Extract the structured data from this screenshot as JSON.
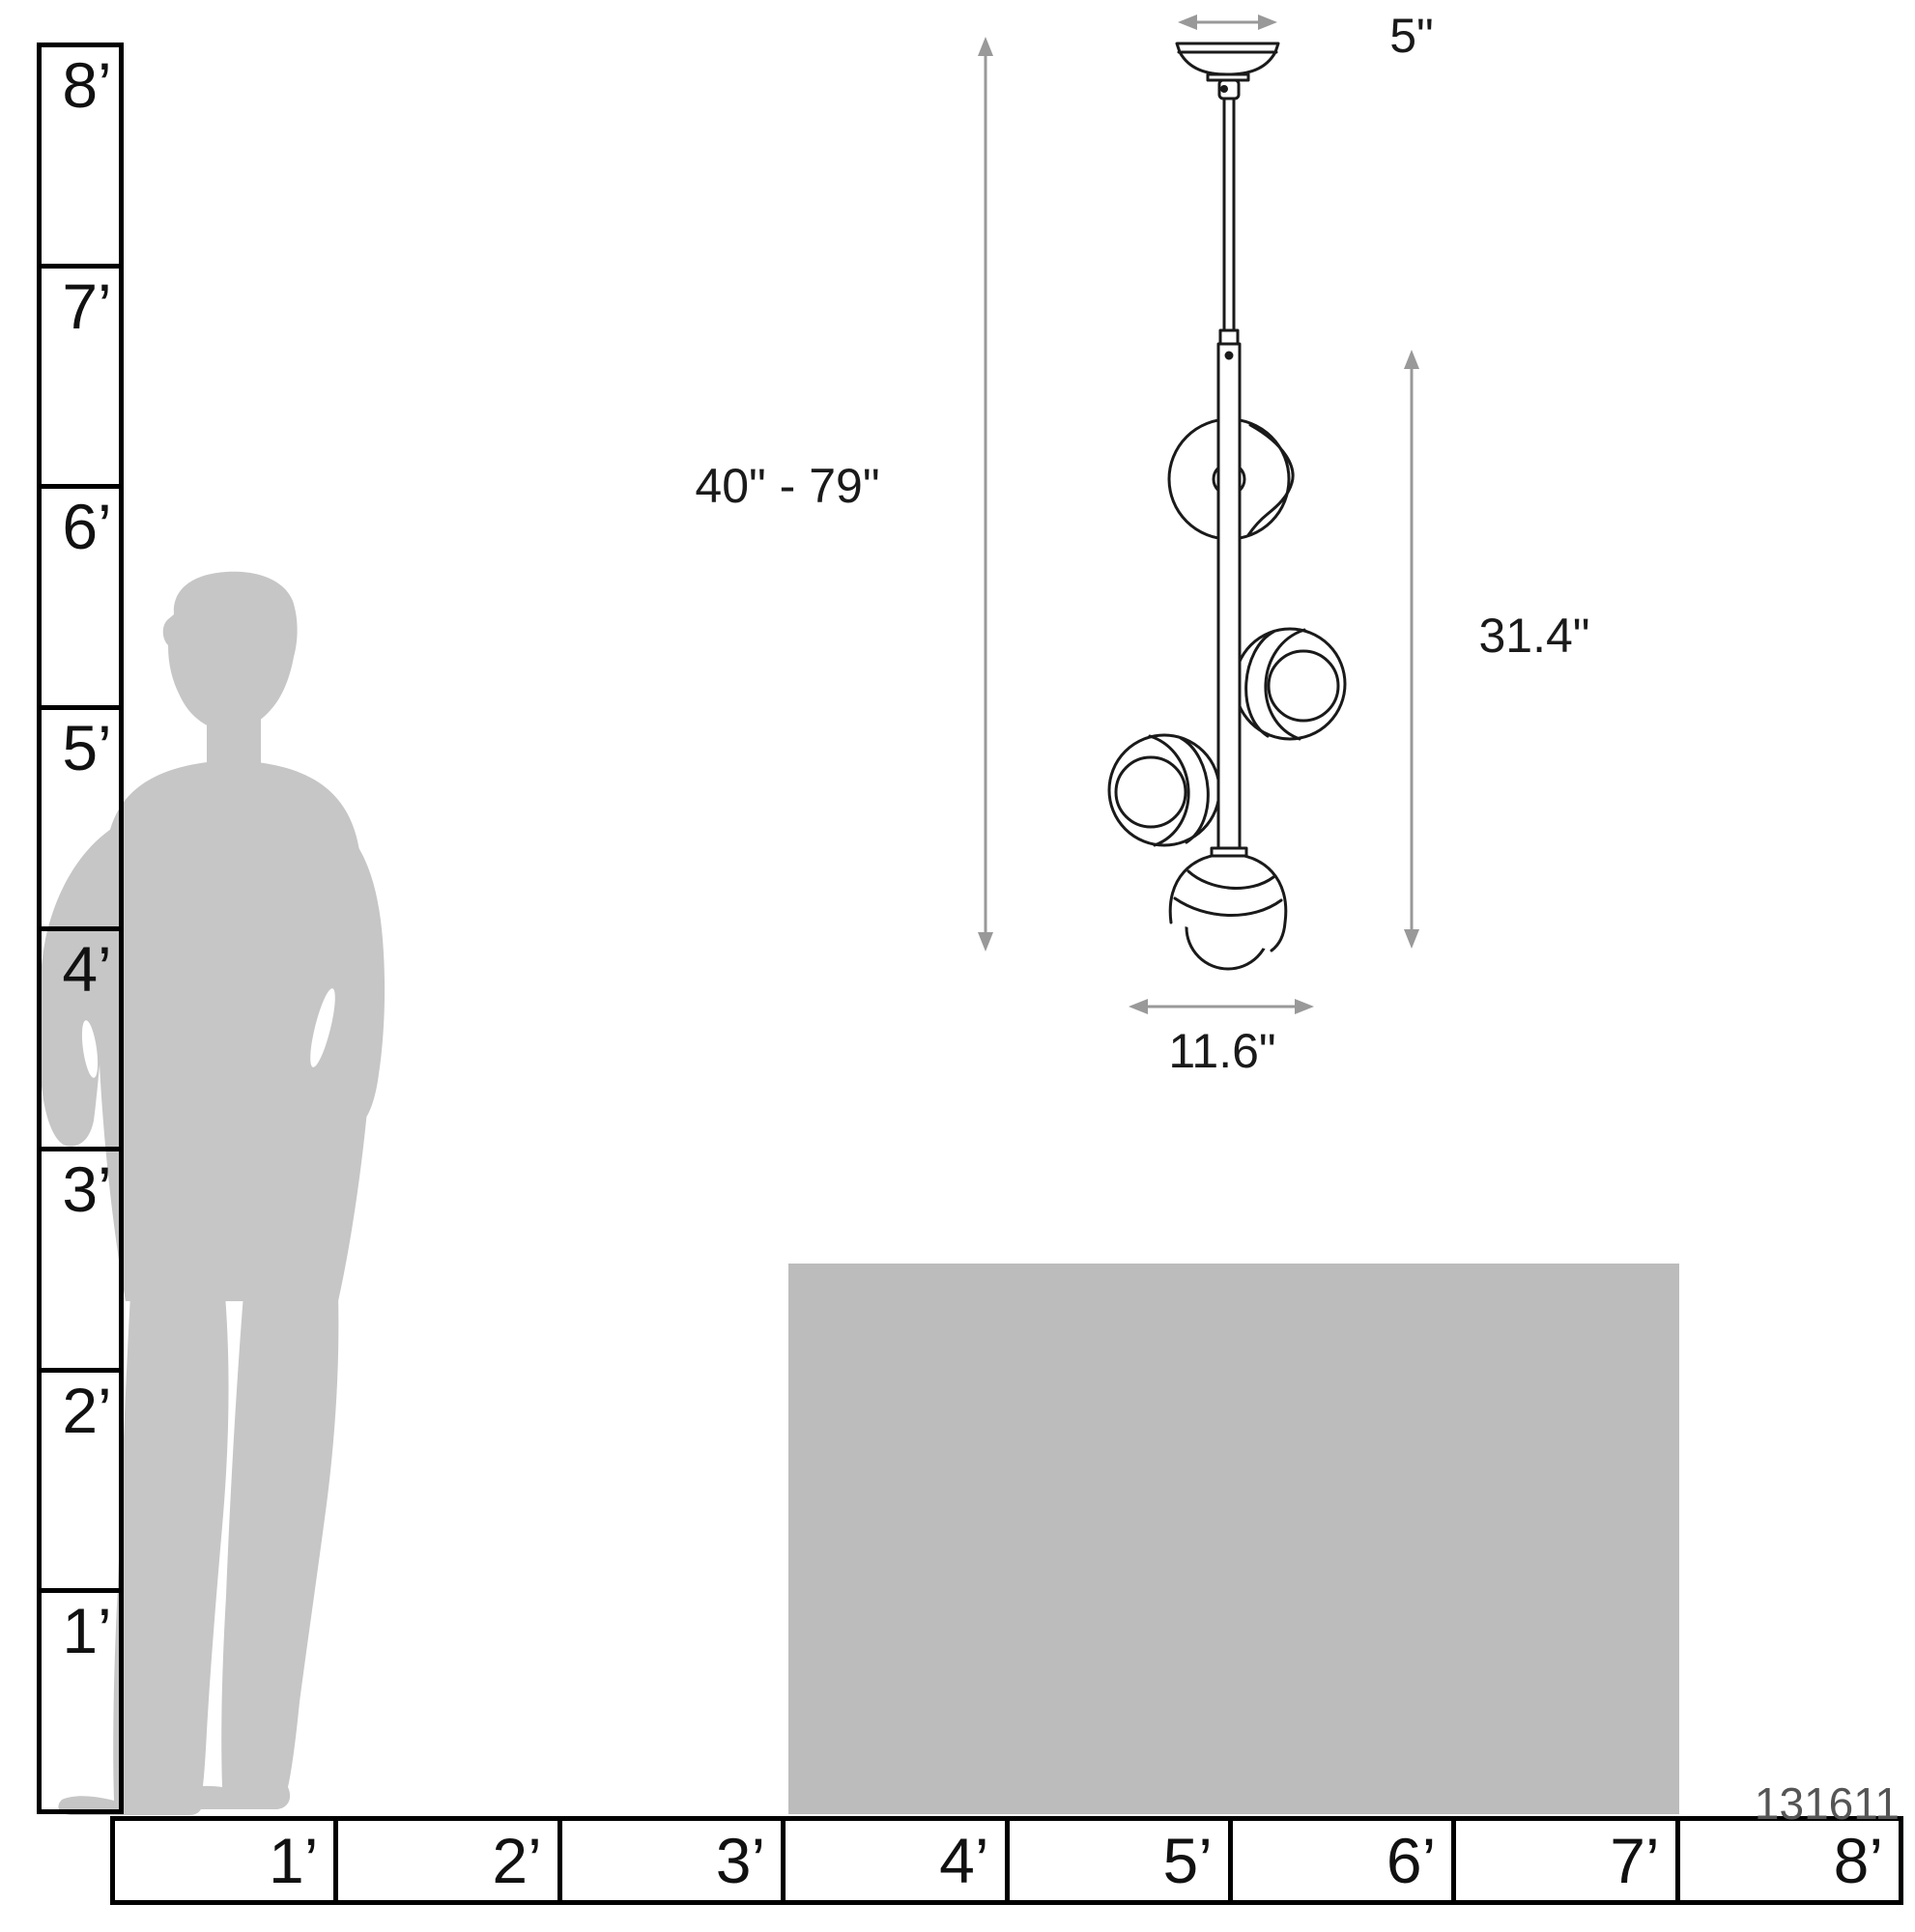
{
  "diagram_title": "pendant-light-scale-diagram",
  "product_code": "131611",
  "dimensions": {
    "canopy_width": "5\"",
    "overall_height": "40\" - 79\"",
    "fixture_height": "31.4\"",
    "fixture_width": "11.6\""
  },
  "vertical_ruler": {
    "unit": "feet",
    "labels": [
      "8’",
      "7’",
      "6’",
      "5’",
      "4’",
      "3’",
      "2’",
      "1’"
    ]
  },
  "horizontal_ruler": {
    "unit": "feet",
    "labels": [
      "1’",
      "2’",
      "3’",
      "4’",
      "5’",
      "6’",
      "7’",
      "8’"
    ]
  },
  "colors": {
    "silhouette_gray": "#c6c6c6",
    "furniture_gray": "#bcbcbc",
    "line_black": "#1a1a1a",
    "arrow_gray": "#999999",
    "background": "#ffffff"
  }
}
